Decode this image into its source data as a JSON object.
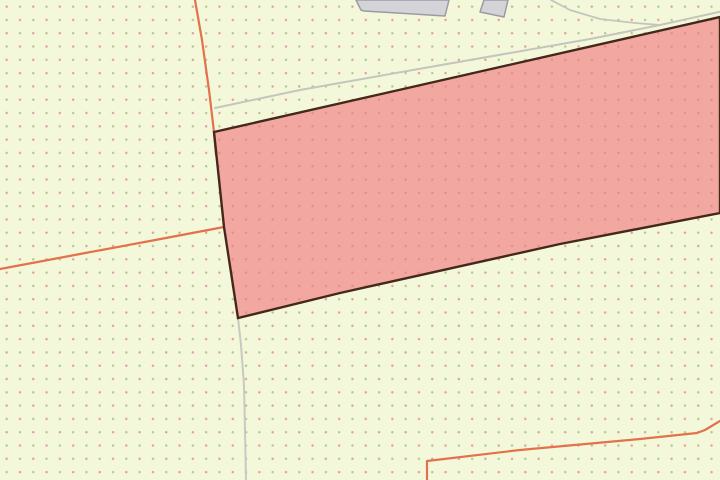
{
  "map": {
    "canvas": {
      "width": 720,
      "height": 480
    },
    "background": {
      "base_color": "#f4f8da",
      "dot_spacing": 13.3,
      "dot_radius": 1.2,
      "dot_color_pink": "#e59a94",
      "dot_color_green": "#b5c488"
    },
    "parcel": {
      "name": "highlighted-parcel",
      "points": [
        [
          214,
          132
        ],
        [
          720,
          17
        ],
        [
          720,
          213
        ],
        [
          560,
          244
        ],
        [
          340,
          293
        ],
        [
          238,
          318
        ],
        [
          224,
          227
        ]
      ],
      "fill": "#f2a8a0",
      "dot_color": "#e28d85",
      "dot_spacing": 13.3,
      "dot_radius": 1.2,
      "stroke": "#45281c",
      "stroke_width": 2.4
    },
    "boundary_lines": [
      {
        "name": "boundary-line-north",
        "points": [
          [
            195,
            0
          ],
          [
            202,
            40
          ],
          [
            209,
            90
          ],
          [
            214,
            132
          ],
          [
            216,
            155
          ]
        ],
        "color": "#e3714b",
        "width": 2.2
      },
      {
        "name": "boundary-line-west",
        "points": [
          [
            0,
            269
          ],
          [
            80,
            254
          ],
          [
            150,
            241
          ],
          [
            224,
            227
          ]
        ],
        "color": "#e3714b",
        "width": 2.2
      },
      {
        "name": "boundary-line-southeast",
        "points": [
          [
            427,
            480
          ],
          [
            427,
            461
          ],
          [
            520,
            450
          ],
          [
            640,
            439
          ],
          [
            697,
            433
          ],
          [
            705,
            430
          ],
          [
            720,
            421
          ]
        ],
        "color": "#e3714b",
        "width": 2.2
      }
    ],
    "roads": [
      {
        "name": "road-edge-north",
        "points": [
          [
            215,
            108
          ],
          [
            300,
            90
          ],
          [
            430,
            67
          ],
          [
            590,
            39
          ],
          [
            660,
            25
          ],
          [
            728,
            10
          ]
        ],
        "color": "#c4c5bd",
        "width": 2
      },
      {
        "name": "road-branch-north",
        "points": [
          [
            551,
            0
          ],
          [
            570,
            10
          ],
          [
            600,
            19
          ],
          [
            635,
            23
          ],
          [
            660,
            25
          ]
        ],
        "color": "#c4c5bd",
        "width": 1.8
      },
      {
        "name": "path-south",
        "points": [
          [
            238,
            318
          ],
          [
            241,
            345
          ],
          [
            244,
            385
          ],
          [
            245,
            430
          ],
          [
            246,
            480
          ]
        ],
        "color": "#c8c9c1",
        "width": 2
      }
    ],
    "buildings": [
      {
        "name": "building-footprint-large",
        "points": [
          [
            356,
            0
          ],
          [
            361,
            10
          ],
          [
            364,
            11
          ],
          [
            445,
            16
          ],
          [
            449,
            0
          ]
        ],
        "fill": "#d4d4d8",
        "stroke": "#9b9ba3",
        "stroke_width": 1.5
      },
      {
        "name": "building-footprint-small",
        "points": [
          [
            484,
            0
          ],
          [
            480,
            12
          ],
          [
            504,
            17
          ],
          [
            508,
            0
          ]
        ],
        "fill": "#d4d4d8",
        "stroke": "#9b9ba3",
        "stroke_width": 1.5
      }
    ]
  }
}
